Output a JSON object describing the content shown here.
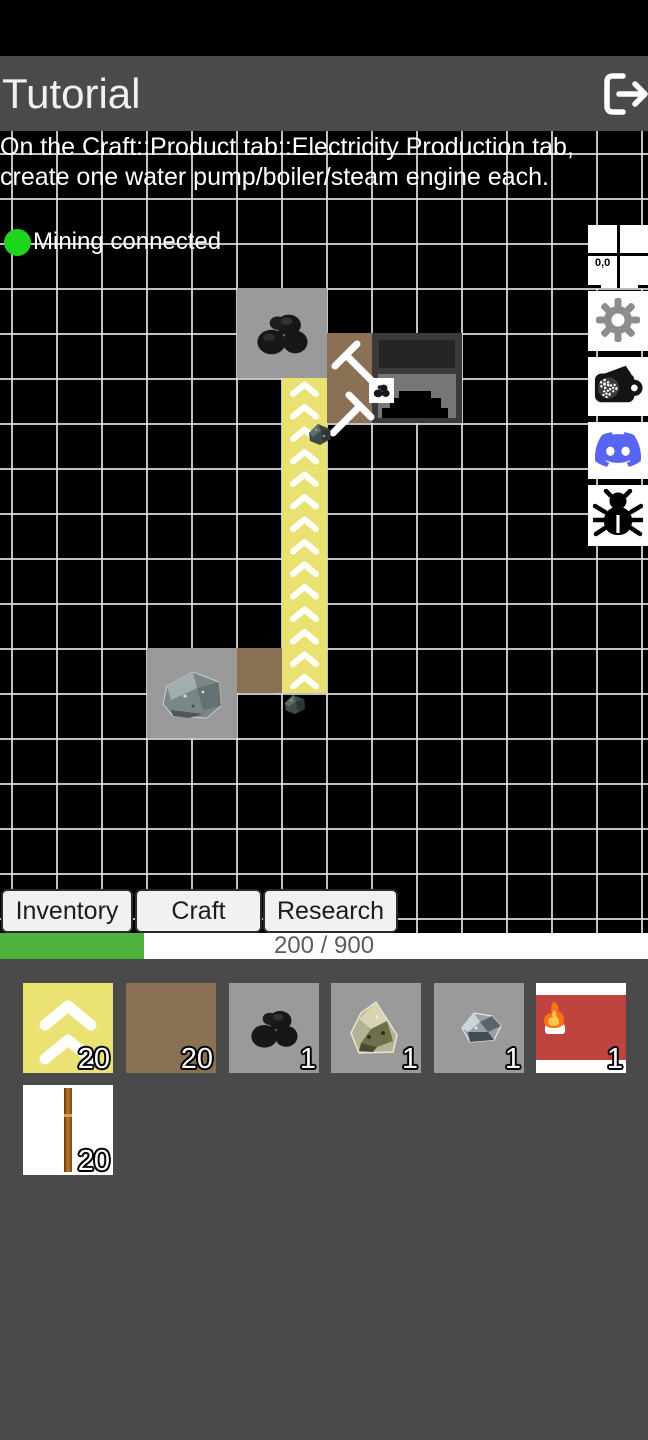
{
  "header": {
    "title": "Tutorial"
  },
  "instruction": {
    "line1": "On the Craft::Product tab::Electricity Production tab,",
    "line2": "create one water pump/boiler/steam engine each."
  },
  "status": {
    "mining_label": "Mining connected",
    "dot_color": "#1fd41f"
  },
  "minimap": {
    "coords_label": "0,0"
  },
  "map": {
    "entities": [
      {
        "type": "coal-deposit"
      },
      {
        "type": "miner",
        "target": "coal"
      },
      {
        "type": "furnace"
      },
      {
        "type": "conveyor-belt",
        "direction": "up"
      },
      {
        "type": "ore-deposit"
      },
      {
        "type": "miner",
        "target": "ore"
      }
    ]
  },
  "side_buttons": [
    {
      "name": "minimap"
    },
    {
      "name": "settings"
    },
    {
      "name": "mod-wallet"
    },
    {
      "name": "discord"
    },
    {
      "name": "bug-report"
    }
  ],
  "tabs": {
    "items": [
      {
        "label": "Inventory"
      },
      {
        "label": "Craft"
      },
      {
        "label": "Research"
      }
    ]
  },
  "progress": {
    "label": "200 / 900",
    "current": 200,
    "max": 900,
    "percent": 22.2
  },
  "inventory": {
    "items": [
      {
        "name": "conveyor-belt",
        "count": "20"
      },
      {
        "name": "miner",
        "count": "20"
      },
      {
        "name": "coal",
        "count": "1"
      },
      {
        "name": "copper-ore",
        "count": "1"
      },
      {
        "name": "iron-ore",
        "count": "1"
      },
      {
        "name": "furnace-item",
        "count": "1"
      },
      {
        "name": "stick",
        "count": "20"
      }
    ]
  },
  "colors": {
    "belt_yellow": "#e9e272",
    "miner_brown": "#8a7156",
    "tile_gray": "#9a9a9a",
    "furnace_red": "#bf4440",
    "progress_green": "#4db33d",
    "discord_blurple": "#5865f2",
    "header_gray": "#4a4a4a",
    "status_green": "#1fd41f"
  }
}
